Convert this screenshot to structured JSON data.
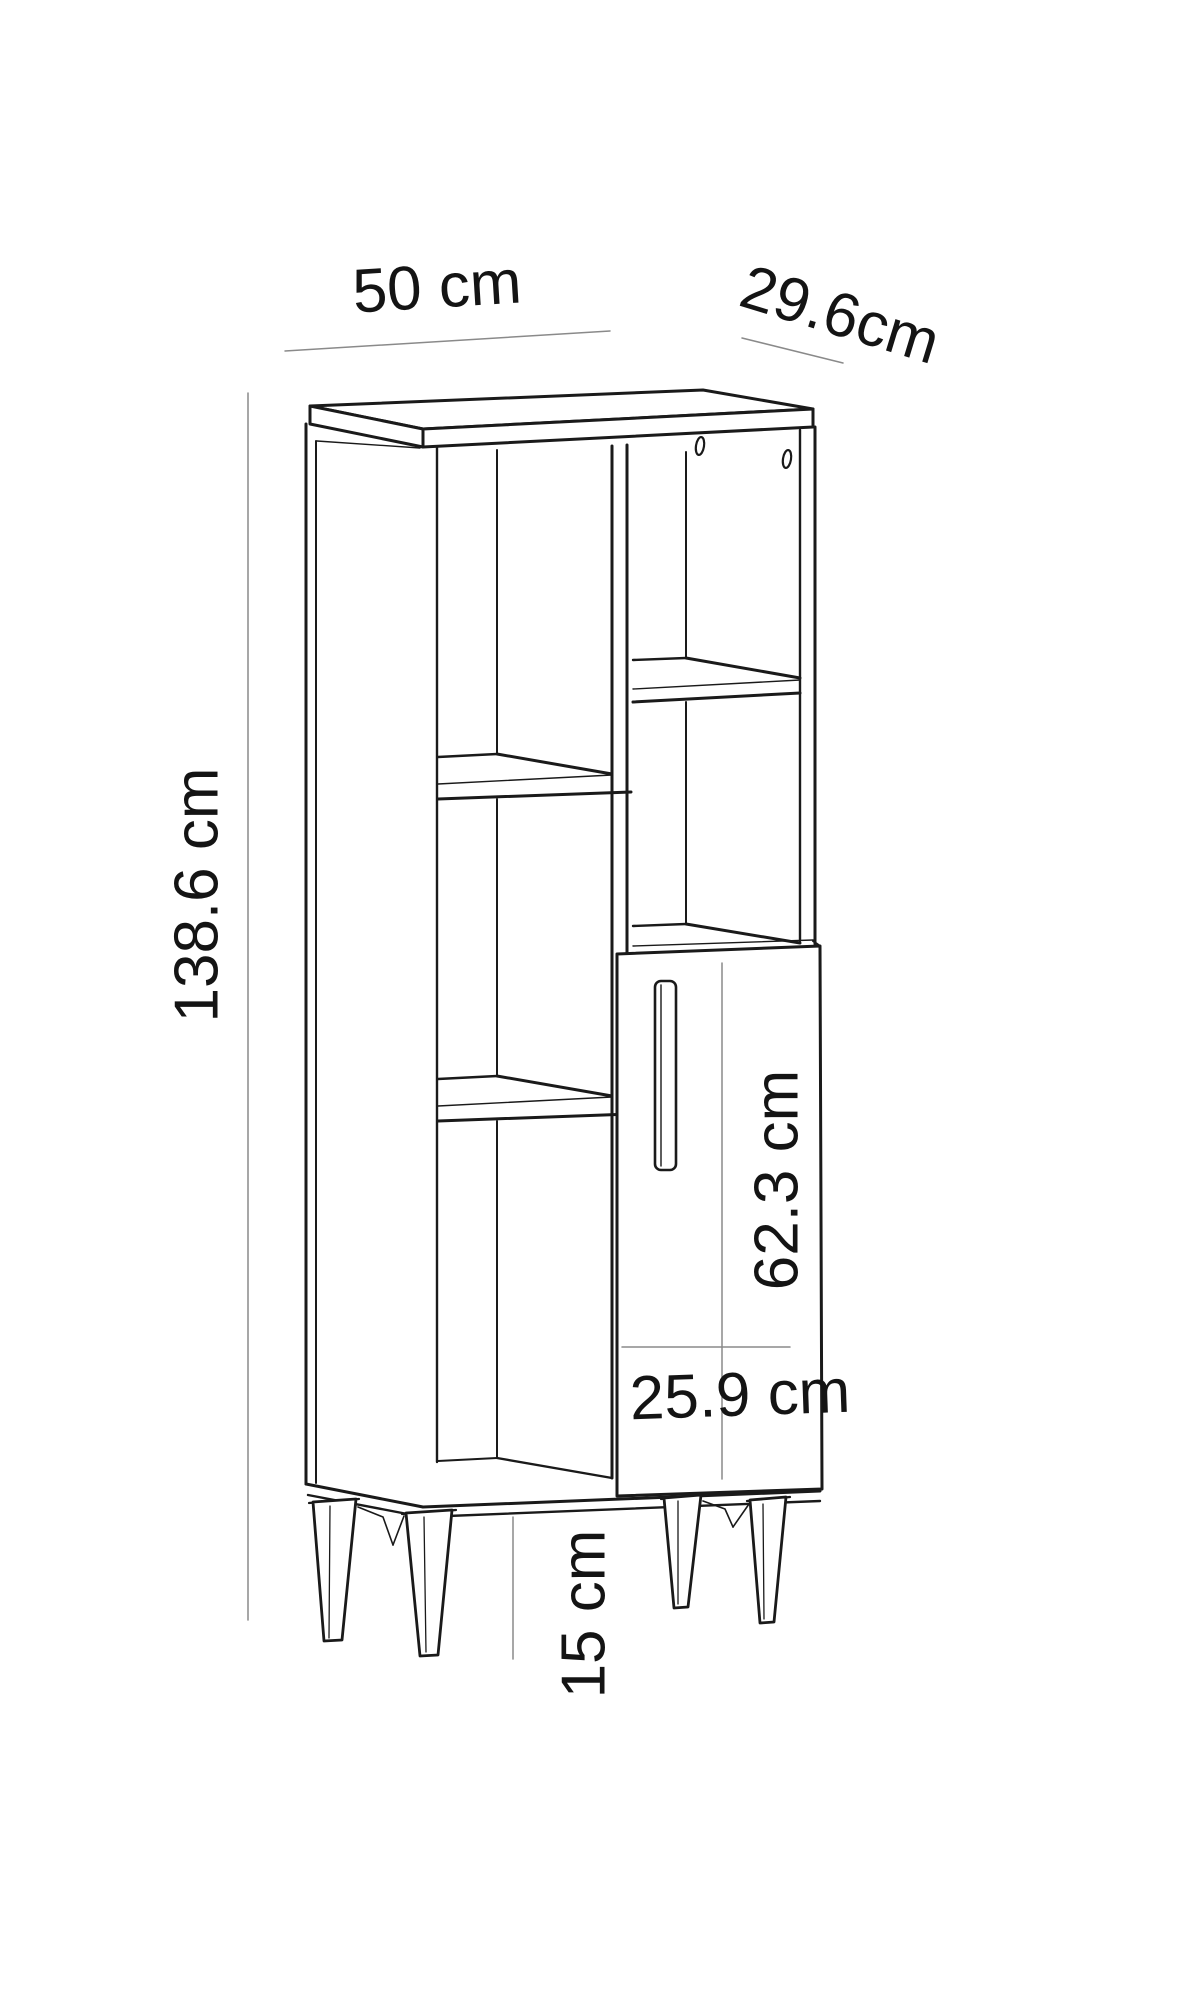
{
  "page": {
    "background": "#ffffff",
    "kind": "furniture-dimension-diagram"
  },
  "drawing": {
    "subject": "tall cabinet with open shelves, lower door and tapered legs",
    "line_color": "#1a1a1a",
    "dimension_line_color": "#8a8a8a",
    "labels": {
      "width_top": "50 cm",
      "depth_top": "29.6cm",
      "overall_height": "138.6 cm",
      "door_height": "62.3 cm",
      "door_width": "25.9 cm",
      "leg_height": "15 cm"
    }
  }
}
